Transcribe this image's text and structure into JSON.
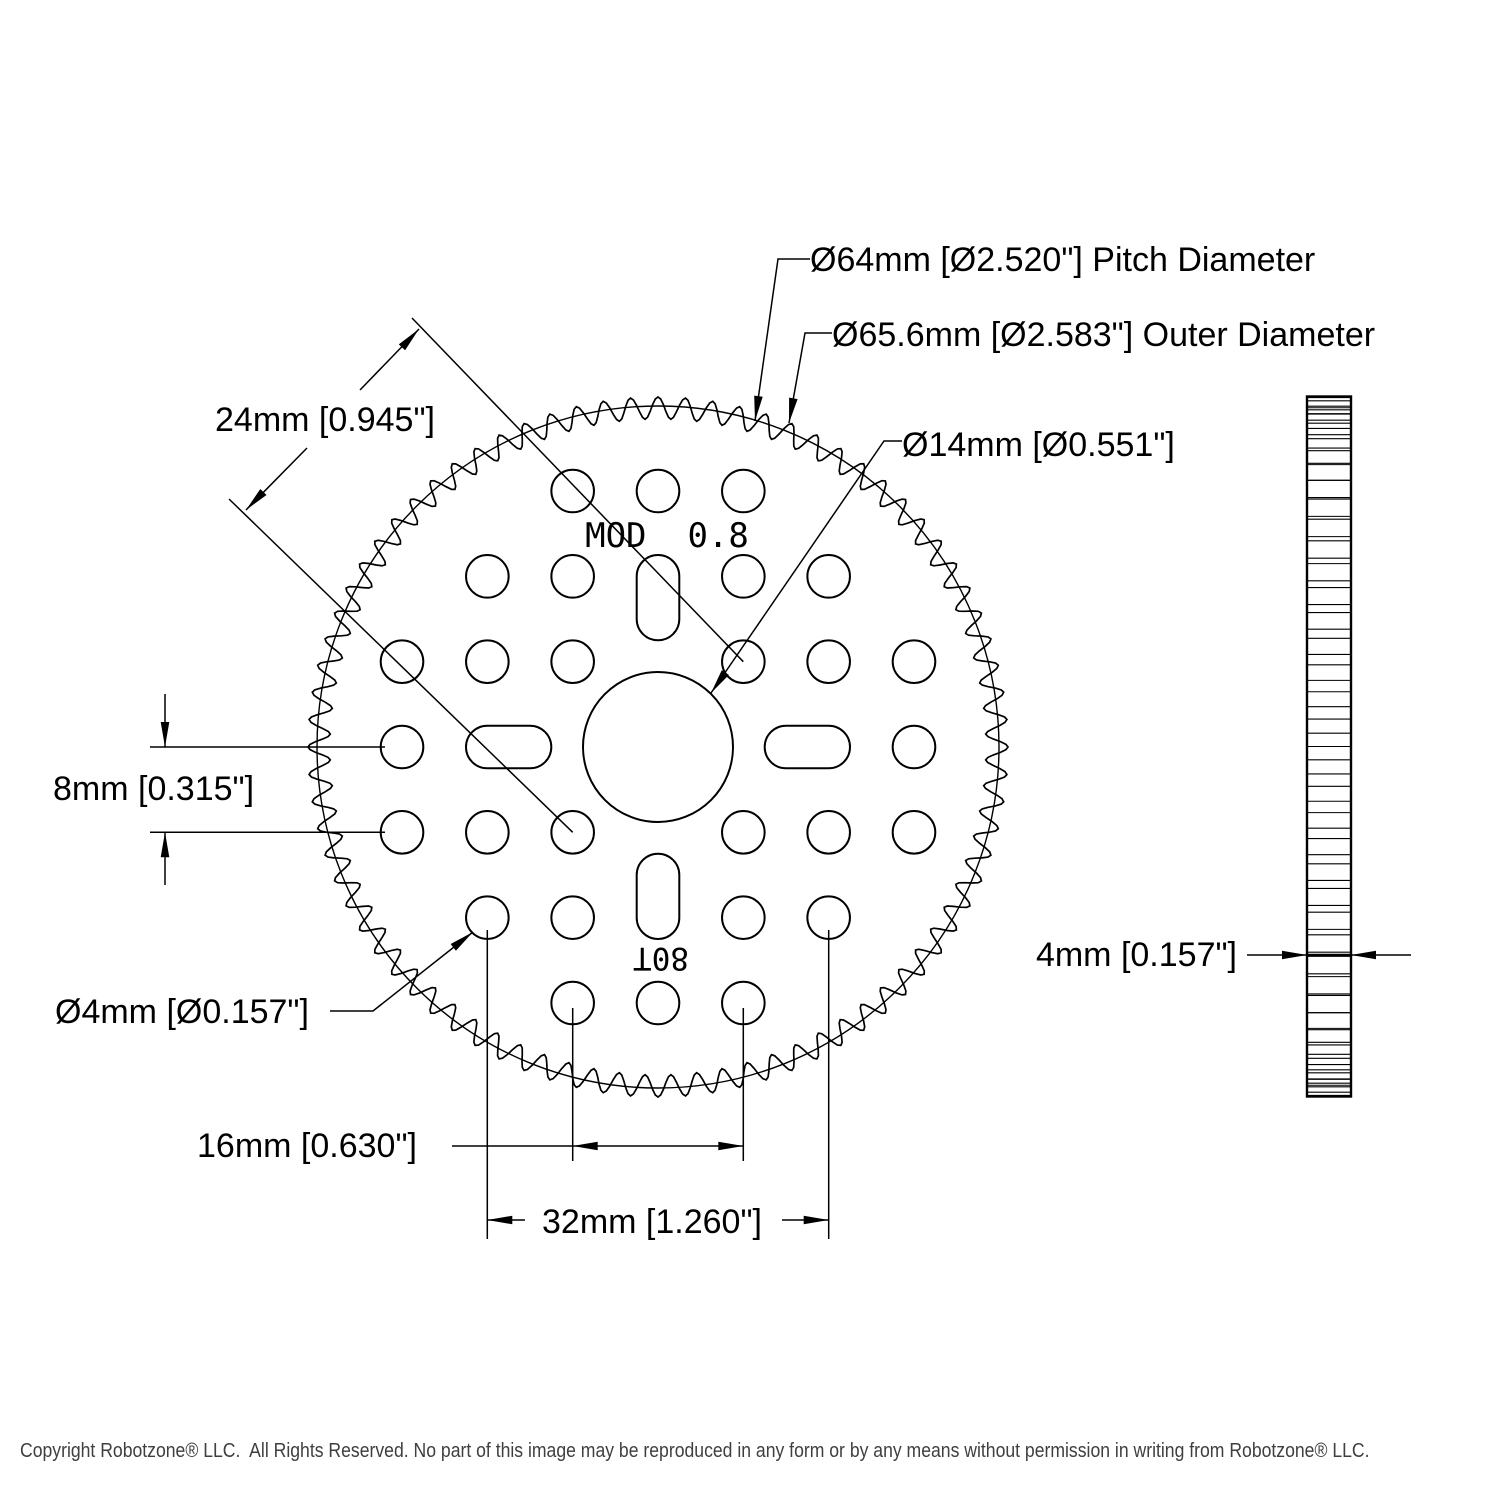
{
  "title": "80 Tooth Hub Gear Technical Drawing",
  "labels": {
    "pitch_diameter": "Ø64mm [Ø2.520\"] Pitch Diameter",
    "outer_diameter": "Ø65.6mm [Ø2.583\"] Outer Diameter",
    "bore_diameter": "Ø14mm [Ø0.551\"]",
    "diagonal_spacing": "24mm [0.945\"]",
    "row_spacing": "8mm [0.315\"]",
    "hole_diameter": "Ø4mm [Ø0.157\"]",
    "hole_spacing_16": "16mm [0.630\"]",
    "hole_spacing_32": "32mm [1.260\"]",
    "thickness": "4mm [0.157\"]",
    "module_marking": "MOD  0.8",
    "tooth_count_marking": "80T"
  },
  "copyright": "Copyright Robotzone® LLC.  All Rights Reserved. No part of this image may be reproduced in any form or by any means without permission in writing from Robotzone® LLC.",
  "drawing": {
    "line_color": "#000000",
    "front_view": {
      "cx": 658,
      "cy": 747,
      "teeth": 80,
      "outer_radius_px": 350,
      "mean_radius_px": 339,
      "tooth_amplitude_px": 11,
      "pitch_radius_px": 341,
      "bore_radius_px": 75,
      "hole_radius_px": 21.3,
      "grid_px": 85.33,
      "holes": [
        [
          -1,
          -3
        ],
        [
          0,
          -3
        ],
        [
          1,
          -3
        ],
        [
          -2,
          -2
        ],
        [
          -1,
          -2
        ],
        [
          1,
          -2
        ],
        [
          2,
          -2
        ],
        [
          -3,
          -1
        ],
        [
          -2,
          -1
        ],
        [
          -1,
          -1
        ],
        [
          1,
          -1
        ],
        [
          2,
          -1
        ],
        [
          3,
          -1
        ],
        [
          -3,
          0
        ],
        [
          3,
          0
        ],
        [
          -3,
          1
        ],
        [
          -2,
          1
        ],
        [
          -1,
          1
        ],
        [
          1,
          1
        ],
        [
          2,
          1
        ],
        [
          3,
          1
        ],
        [
          -2,
          2
        ],
        [
          -1,
          2
        ],
        [
          1,
          2
        ],
        [
          2,
          2
        ],
        [
          -1,
          3
        ],
        [
          0,
          3
        ],
        [
          1,
          3
        ]
      ],
      "slot_inner_px": 106.7,
      "slot_outer_px": 192,
      "slot_half_width_px": 21.3
    },
    "side_view": {
      "x": 1307,
      "w": 44,
      "cy": 746.5,
      "half_height_px": 350,
      "root_radius_px": 339,
      "teeth": 80,
      "marked_line_y": 955
    }
  }
}
